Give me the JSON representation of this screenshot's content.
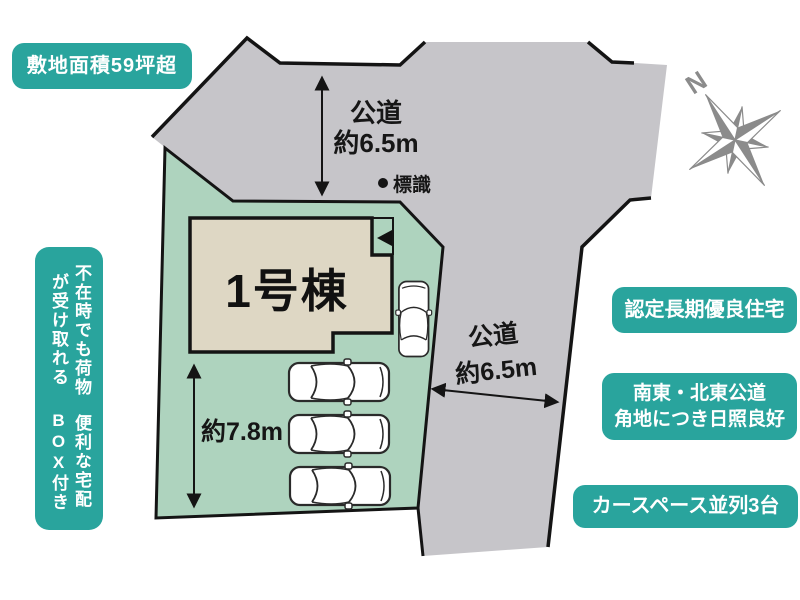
{
  "plan": {
    "house_label": "1号棟",
    "road_top_name": "公道",
    "road_top_width": "約6.5m",
    "road_right_name": "公道",
    "road_right_width": "約6.5m",
    "depth_dim": "約7.8m",
    "sign_label": "標識",
    "compass_n": "N"
  },
  "badges": {
    "site_area": "敷地面積59坪超",
    "delivery_box_line1": "不在時でも荷物が受け取れる",
    "delivery_box_line2": "便利な宅配BOX付き",
    "certified": "認定長期優良住宅",
    "corner_line1": "南東・北東公道",
    "corner_line2": "角地につき日照良好",
    "car_space": "カースペース並列3台"
  },
  "colors": {
    "badge_teal": "#29a49d",
    "plot_green": "#aed3be",
    "road_gray": "#c6c5c9",
    "house_beige": "#ded7c4",
    "line_black": "#141414",
    "compass_gray": "#8b8b8b"
  }
}
